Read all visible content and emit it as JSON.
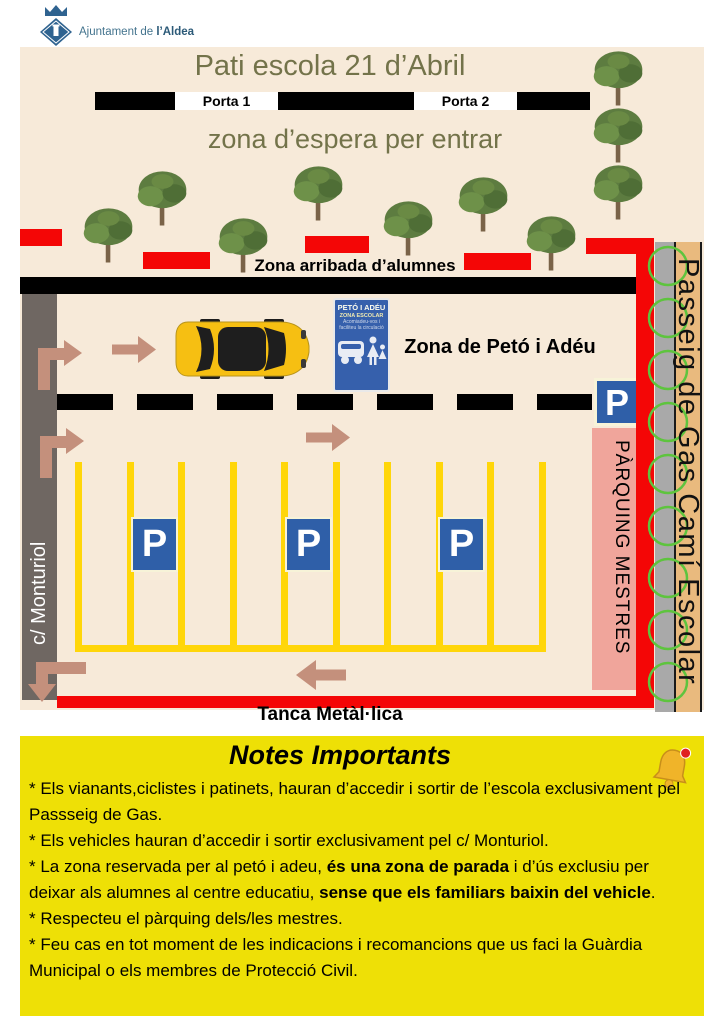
{
  "header": {
    "org_prefix": "Ajuntament de ",
    "org_bold": "l’Aldea"
  },
  "map": {
    "title": "Pati escola 21 d’Abril",
    "porta1": "Porta 1",
    "porta2": "Porta 2",
    "waiting_zone": "zona d’espera per entrar",
    "arrival_zone": "Zona arribada d’alumnes",
    "kiss_sign": {
      "title": "PETÓ I ADÉU",
      "line1": "ZONA ESCOLAR",
      "line2": "Acomiadeu-vos i",
      "line3": "faciliteu la circulació"
    },
    "kiss_label": "Zona de Petó i Adéu",
    "street_left": "c/ Monturiol",
    "teachers_parking": "PÀRQUING MESTRES",
    "promenade": "Passeig de Gas Camí Escolar",
    "fence": "Tanca Metàl·lica",
    "parking_letter": "P"
  },
  "notes": {
    "title": "Notes Importants",
    "items": [
      [
        {
          "t": "* Els vianants,ciclistes i patinets, hauran d’accedir i sortir de l’escola exclusivament pel Passseig de Gas.",
          "b": false
        }
      ],
      [
        {
          "t": "* Els vehicles hauran d’accedir i sortir exclusivament pel c/ Monturiol.",
          "b": false
        }
      ],
      [
        {
          "t": "* La zona reservada per al petó i adeu, ",
          "b": false
        },
        {
          "t": "és una zona de parada",
          "b": true
        },
        {
          "t": " i d’ús exclusiu per deixar als alumnes al centre educatiu, ",
          "b": false
        },
        {
          "t": "sense que els familiars baixin del vehicle",
          "b": true
        },
        {
          "t": ".",
          "b": false
        }
      ],
      [
        {
          "t": "* Respecteu el pàrquing dels/les mestres.",
          "b": false
        }
      ],
      [
        {
          "t": "* Feu cas en tot moment de les indicacions i recomancions que us faci la Guàrdia Municipal o els membres de Protecció Civil.",
          "b": false
        }
      ]
    ]
  },
  "icons": {
    "logo": "municipal-crest-icon",
    "tree": "tree-icon",
    "car": "car-icon",
    "parking": "parking-sign-icon",
    "bell": "bell-icon",
    "arrows": [
      "entry-arrow-icon",
      "flow-arrow-right-icon",
      "flow-arrow-left-icon",
      "exit-arrow-icon"
    ]
  },
  "colors": {
    "red": "#f40606",
    "beige": "#f7ead9",
    "olive": "#73734a",
    "yellow": "#ffd60a",
    "notes_bg": "#eee006",
    "blue": "#2f5fa8",
    "pink": "#f0a59b",
    "tan": "#e9ba7e",
    "gray_left": "#6f6762",
    "gray_right": "#a9a9a9",
    "arrow": "#c4907c",
    "green": "#5ec43e",
    "logo_blue": "#2f6390",
    "header_text": "#44748e"
  }
}
